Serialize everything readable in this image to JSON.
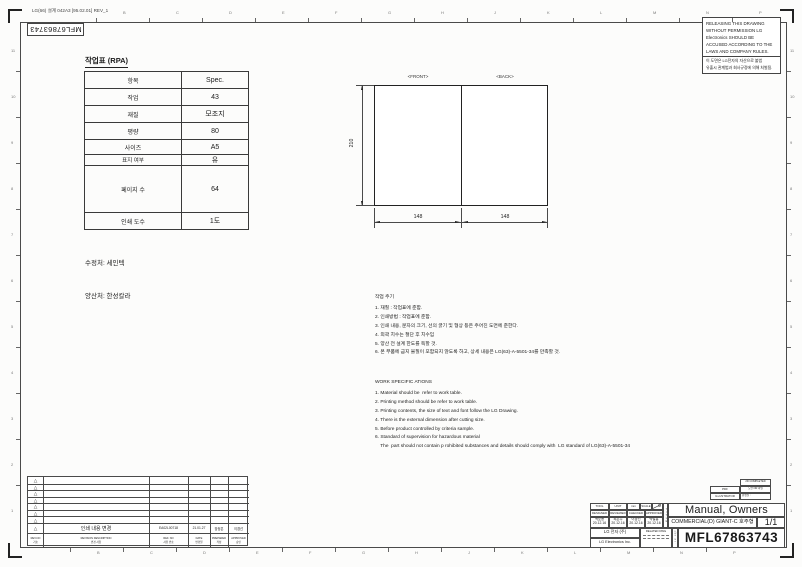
{
  "sheet": {
    "stamp": "LG(66) 설계 042A3 [95.02.01] REV_1",
    "doc_code": "MFL67863743"
  },
  "zones": {
    "top": [
      "B",
      "C",
      "D",
      "E",
      "F",
      "G",
      "H",
      "J",
      "K",
      "L",
      "M",
      "N",
      "P"
    ],
    "bottom": [
      "B",
      "C",
      "D",
      "E",
      "F",
      "G",
      "H",
      "J",
      "K",
      "L",
      "M",
      "N",
      "P"
    ],
    "left": [
      "11",
      "10",
      "9",
      "8",
      "7",
      "6",
      "5",
      "4",
      "3",
      "2",
      "1"
    ],
    "right": [
      "11",
      "10",
      "9",
      "8",
      "7",
      "6",
      "5",
      "4",
      "3",
      "2",
      "1"
    ]
  },
  "warning": {
    "en_lines": [
      "RELEASING THIS DRAWING",
      "WITHOUT PERMISSION LG",
      "Electronics SHOULD BE",
      "ACCUSED ACCORDING TO THE",
      "LAWS AND COMPANY RULES."
    ],
    "kr_lines": [
      "이 도면은 LG전자의 자산으로 불법",
      "유출시 관계법과 회사규정에 의해 처벌됨."
    ]
  },
  "work_table": {
    "title": "작업표 (RPA)",
    "rows": [
      {
        "label": "항목",
        "value": "Spec."
      },
      {
        "label": "작업",
        "value": "43"
      },
      {
        "label": "재질",
        "value": "모조지"
      },
      {
        "label": "평량",
        "value": "80"
      },
      {
        "label": "사이즈",
        "value": "A5"
      },
      {
        "label": "표지 여부",
        "value": "유"
      },
      {
        "label": "페이지 수",
        "value": "64"
      },
      {
        "label": "인쇄 도수",
        "value": "1도"
      }
    ]
  },
  "vendors": {
    "line1": "수정처: 세인텍",
    "line2": "양산처: 한성칼라"
  },
  "drawing": {
    "front": "<FRONT>",
    "back": "<BACK>",
    "height": "210",
    "w1": "148",
    "w2": "148"
  },
  "notes_kr": {
    "title": "작업 주기",
    "lines": [
      "1. 재질 : 작업표에 준함.",
      "2. 인쇄방법 : 작업표에 준함.",
      "3. 인쇄 내용, 문자의 크기, 선의 굵기 및 형상 등은 주어진 도면에 준한다.",
      "4. 외곽 치수는 절단 후 치수임",
      "5. 양산 전 설계 한도를 득할 것.",
      "6. 본 부품에 금지 물질이 포함되지 않도록 하고, 상세 내용은 LG(63)-A-5501-34를 만족할 것."
    ]
  },
  "notes_en": {
    "title": "WORK SPECIFIC ATIONS",
    "lines": [
      "1. Material should be  refer to work table.",
      "2. Printing method should be refer to work table.",
      "3. Printing contents, the size of text and font follow the LG Drawing.",
      "4. There is the external dimension after cutting size.",
      "5. Before product controlled by criteria sample.",
      "6. Standard of supervision for hazardous material",
      "    The  part should not contain p rohibited substances and details should comply with  LG standard of LG(63)-A-5501-34"
    ]
  },
  "title_block": {
    "file_box": {
      "top": "PDF",
      "bottom": "ILLUSTRATOR"
    },
    "complete_box": {
      "line1": "2D COMPLETED",
      "line2": "도면 OR 파일",
      "line3": "완성일 :"
    },
    "headers": {
      "tool": "TOOL",
      "unit": "UNIT",
      "unit_value": "mm",
      "scale": "SCALE"
    },
    "sign_headers": [
      "DESIGNED",
      "REVIEWED",
      "CHECKED",
      "APPROVED"
    ],
    "signs": [
      {
        "name": "백호용",
        "date": "20.12.16"
      },
      {
        "name": "최은주",
        "date": "20.12.16"
      },
      {
        "name": "이경선",
        "date": "20.12.16"
      },
      {
        "name": "박철흥",
        "date": "20.12.16"
      }
    ],
    "company_kr": "LG 전자  (주)",
    "company_en": "LG Electronics Inc.",
    "related_dwg": "RELATED DWG",
    "title_label": "TITLE",
    "dwg_no_label": "DWG No.",
    "title": "Manual, Owners",
    "subtitle": "COMMERCIAL(D) GIANT-C 호주형",
    "sheet_no": "1/1",
    "dwg_no": "MFL67863743"
  },
  "revision_table": {
    "entry": {
      "description": "인쇄 내용 변경",
      "ref_no": "EA02L00718",
      "date": "21.01.27",
      "prepared": "장정은",
      "approved": "이경선"
    },
    "headers": [
      {
        "en": "REV.NO",
        "kr": "기호"
      },
      {
        "en": "REVISION DESCRIPTION",
        "kr": "변경 사항"
      },
      {
        "en": "REF. NO",
        "kr": "사유 번호"
      },
      {
        "en": "DATE",
        "kr": "변경일"
      },
      {
        "en": "PREPARED",
        "kr": "작성"
      },
      {
        "en": "APPROVED",
        "kr": "승인"
      }
    ]
  }
}
